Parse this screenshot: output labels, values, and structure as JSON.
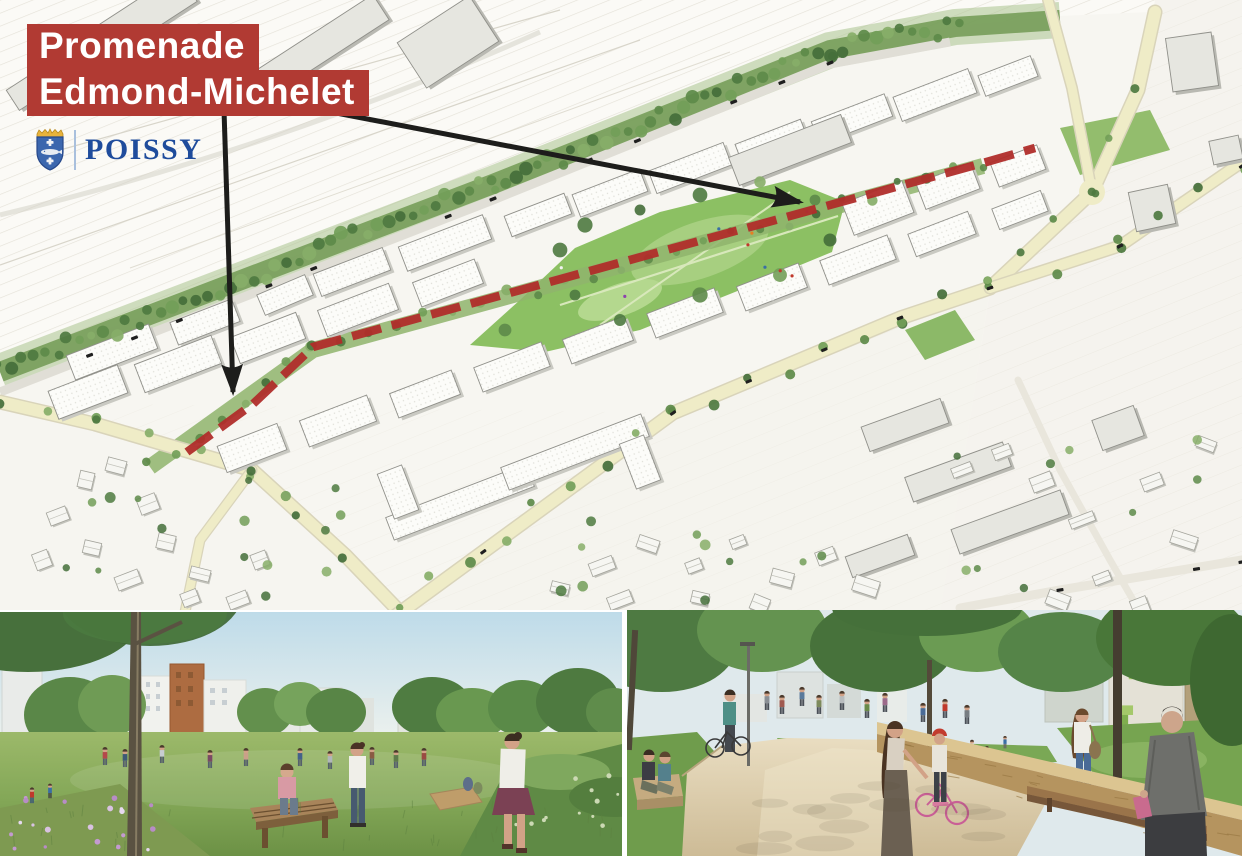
{
  "title": {
    "line1": "Promenade",
    "line2": "Edmond-Michelet"
  },
  "logo": {
    "city_name": "POISSY"
  },
  "colors": {
    "title_box_red": "#b13a33",
    "promenade_red": "#b02d2a",
    "arrow_black": "#1d1d1b",
    "logo_blue": "#1f4c9c",
    "park_green": "#8cc063",
    "road_yellow": "#efecc7"
  },
  "map": {
    "promenade_route": {
      "label": "Promenade Edmond-Michelet",
      "points": [
        [
          187,
          452
        ],
        [
          253,
          404
        ],
        [
          313,
          347
        ],
        [
          983,
          163
        ],
        [
          1035,
          148
        ]
      ],
      "stroke_width": 8.5,
      "dash_pattern": [
        30,
        11
      ]
    },
    "arrows": [
      {
        "name": "arrow-to-promenade-west",
        "from": [
          224,
          110
        ],
        "to": [
          233,
          392
        ]
      },
      {
        "name": "arrow-to-promenade-east",
        "from": [
          258,
          98
        ],
        "to": [
          800,
          202
        ]
      }
    ]
  }
}
